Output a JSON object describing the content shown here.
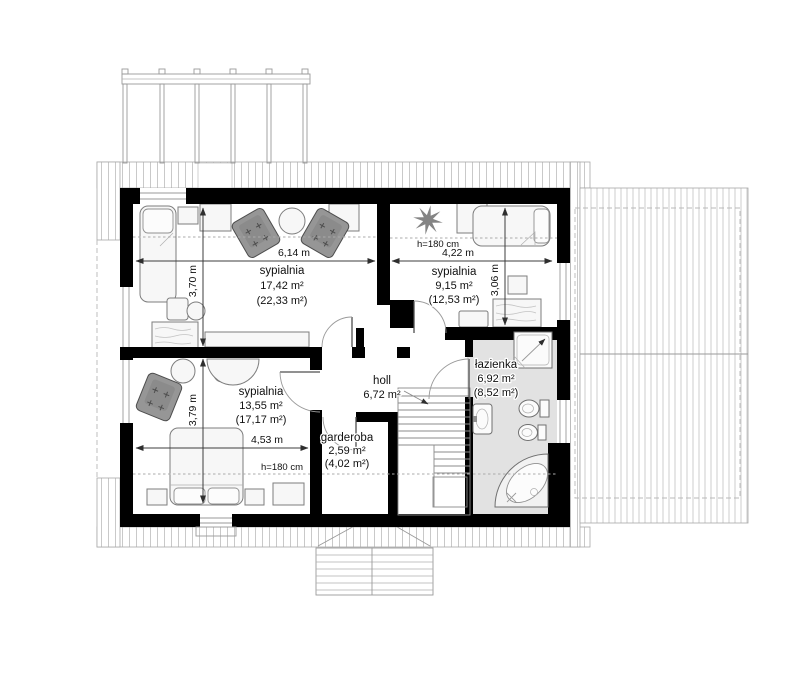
{
  "plan": {
    "type": "floor-plan",
    "rooms": {
      "bedroom1": {
        "name": "sypialnia",
        "area": "17,42 m²",
        "area_roof": "(22,33 m²)"
      },
      "bedroom2": {
        "name": "sypialnia",
        "area": "9,15 m²",
        "area_roof": "(12,53 m²)"
      },
      "bedroom3": {
        "name": "sypialnia",
        "area": "13,55 m²",
        "area_roof": "(17,17 m²)"
      },
      "bathroom": {
        "name": "łazienka",
        "area": "6,92 m²",
        "area_roof": "(8,52 m²)"
      },
      "hall": {
        "name": "holl",
        "area": "6,72 m²"
      },
      "wardrobe": {
        "name": "garderoba",
        "area": "2,59 m²",
        "area_roof": "(4,02 m²)"
      }
    },
    "dimensions": {
      "bedroom1_width": "6,14 m",
      "bedroom1_depth": "3,70 m",
      "bedroom2_width": "4,22 m",
      "bedroom2_depth": "3,06 m",
      "bedroom3_width": "4,53 m",
      "bedroom3_depth": "3,79 m"
    },
    "height_notes": {
      "bedroom2": "h=180 cm",
      "bedroom3": "h=180 cm"
    },
    "colors": {
      "wall": "#000000",
      "bathroom_floor": "#e2e2e2",
      "upholstery": "#969696",
      "hatch": "#c9c9c9",
      "dimension_line": "#3c3c3c",
      "background": "#ffffff"
    }
  }
}
